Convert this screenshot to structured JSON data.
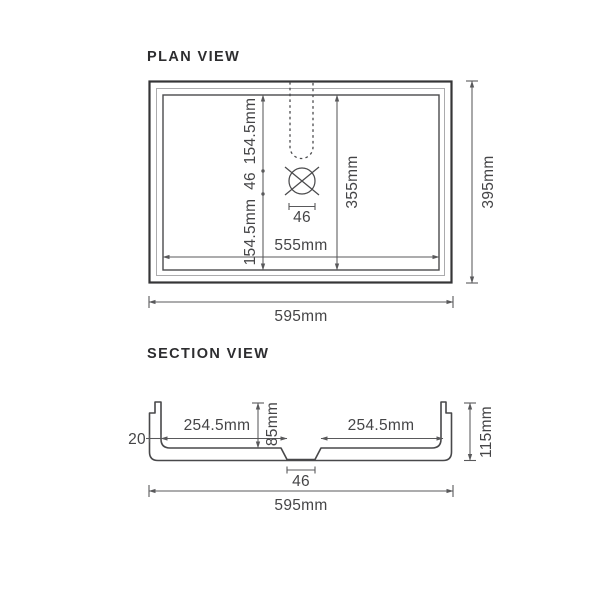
{
  "drawing": {
    "background": "#ffffff",
    "line_color": "#4a4a4c",
    "outer_border_color": "#353537",
    "text_color": "#454547"
  },
  "plan": {
    "title": "PLAN VIEW",
    "dims": {
      "overall_width": "595mm",
      "overall_depth": "395mm",
      "bowl_width": "555mm",
      "bowl_depth": "355mm",
      "seg_top": "154.5mm",
      "seg_mid": "46",
      "seg_bottom": "154.5mm",
      "drain_width": "46"
    }
  },
  "section": {
    "title": "SECTION VIEW",
    "dims": {
      "overall_width": "595mm",
      "overall_height": "115mm",
      "rim_thickness": "20",
      "left_half": "254.5mm",
      "right_half": "254.5mm",
      "bowl_depth": "85mm",
      "drain_width": "46"
    }
  }
}
